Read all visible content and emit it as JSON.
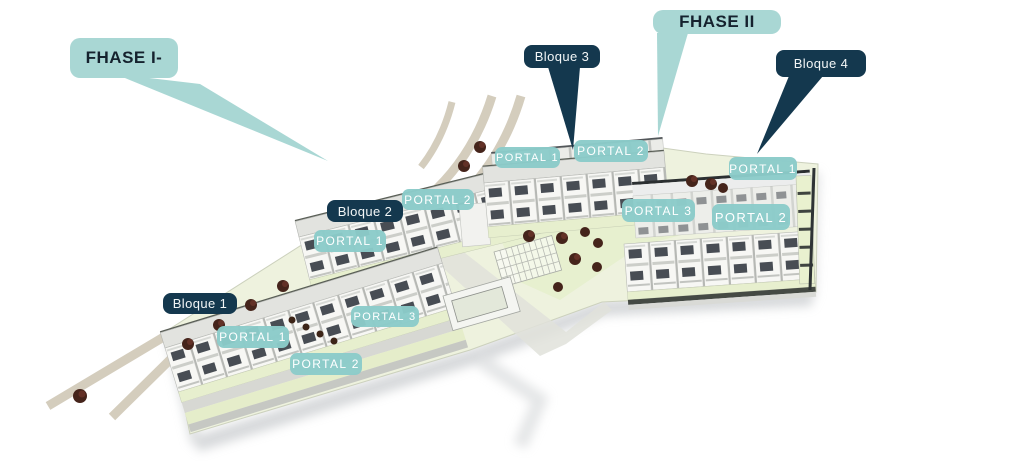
{
  "phase_labels": [
    {
      "id": "fase-1",
      "label": "FHASE I-"
    },
    {
      "id": "fase-2",
      "label": "FHASE II"
    }
  ],
  "block_labels": [
    {
      "id": "bloque-1",
      "label": "Bloque 1"
    },
    {
      "id": "bloque-2",
      "label": "Bloque 2"
    },
    {
      "id": "bloque-3",
      "label": "Bloque 3"
    },
    {
      "id": "bloque-4",
      "label": "Bloque 4"
    }
  ],
  "portal_labels": [
    {
      "id": "bloque3-portal-1",
      "label": "PORTAL 1"
    },
    {
      "id": "bloque3-portal-2",
      "label": "PORTAL 2"
    },
    {
      "id": "bloque4-portal-1",
      "label": "PORTAL 1"
    },
    {
      "id": "phase2-portal-3",
      "label": "PORTAL 3"
    },
    {
      "id": "bloque4-portal-2",
      "label": "PORTAL 2"
    },
    {
      "id": "bloque2-portal-2",
      "label": "PORTAL 2"
    },
    {
      "id": "bloque2-portal-1",
      "label": "PORTAL 1"
    },
    {
      "id": "bloque1-portal-3",
      "label": "PORTAL 3"
    },
    {
      "id": "bloque1-portal-1",
      "label": "PORTAL 1"
    },
    {
      "id": "bloque1-portal-2",
      "label": "PORTAL 2"
    }
  ],
  "colors": {
    "phase_teal": "#a9d7d4",
    "portal_teal": "#8bcbc9",
    "bloque_navy": "#14384e",
    "lawn_green": "#e6efcd",
    "road_beige": "#d4cdbd"
  }
}
